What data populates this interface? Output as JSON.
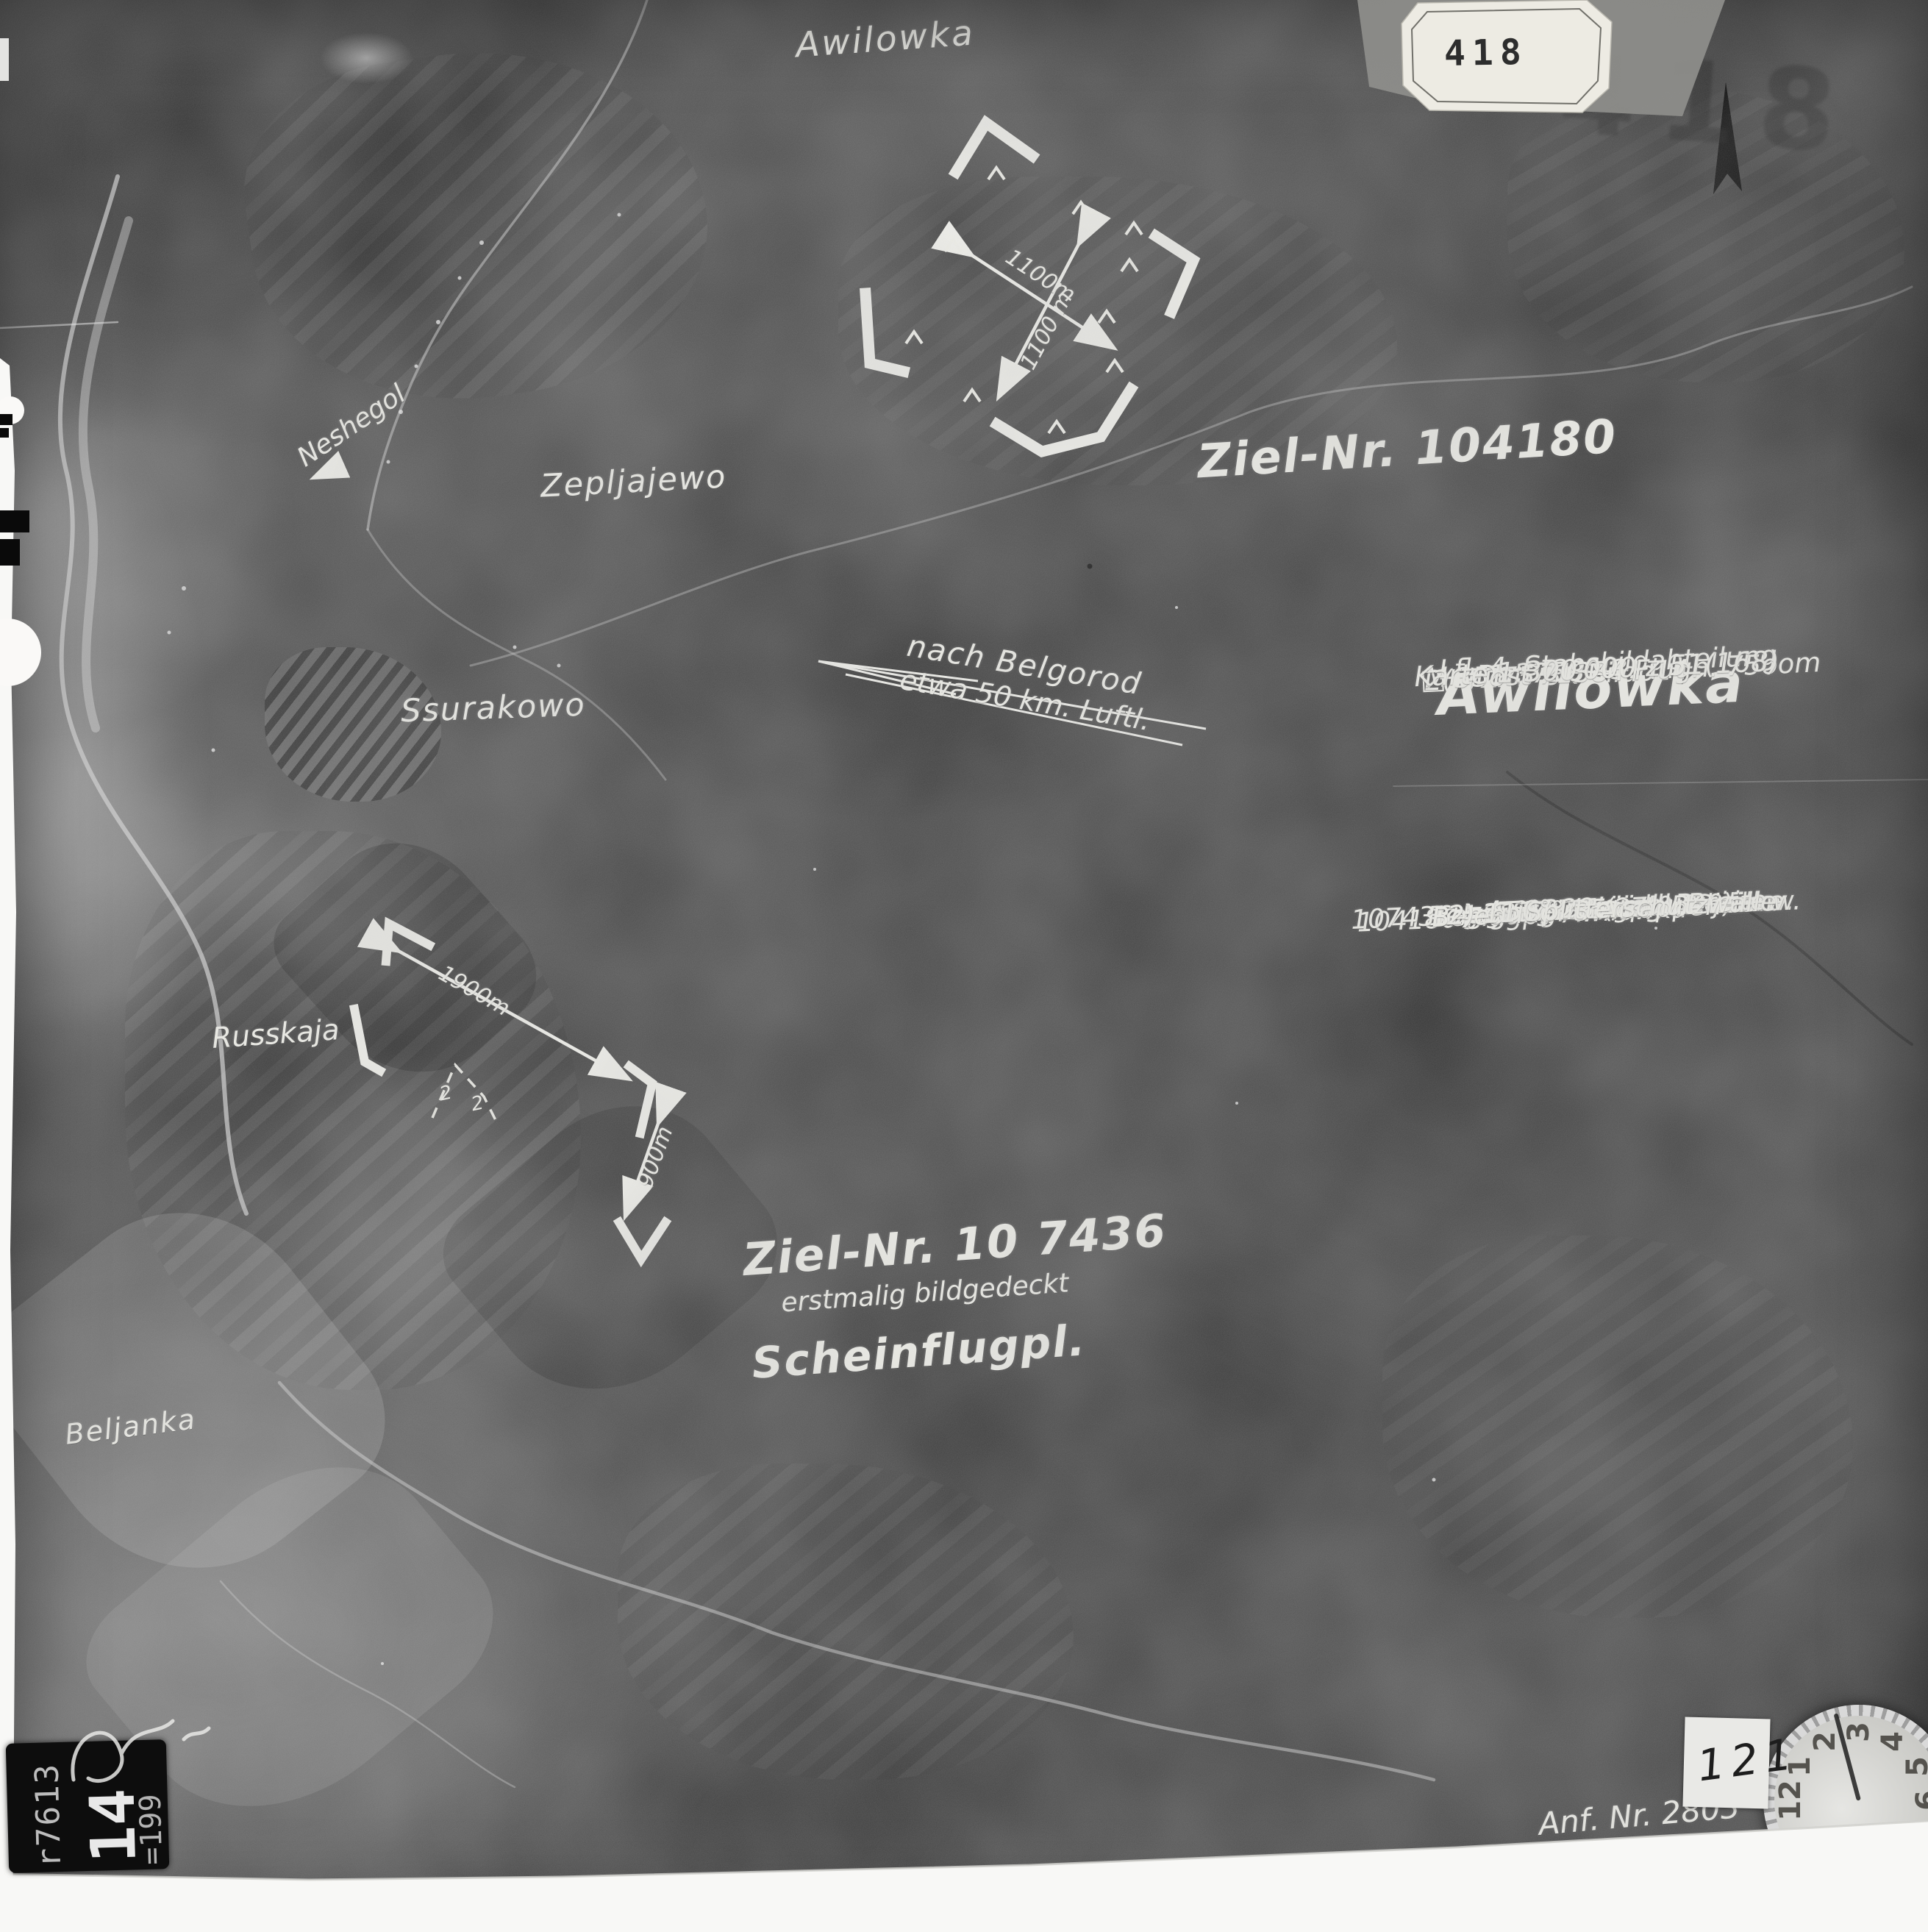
{
  "photo": {
    "tag_number": "418",
    "ghost_number": "418",
    "sticker_number": "121",
    "order_number": "Anf. Nr. 2803",
    "stamp_serial": "r7613",
    "stamp_large": "14",
    "stamp_small": "=199",
    "north_letter": "N",
    "annotation_color": "#eeeee8",
    "paper_color": "#f8f8f6"
  },
  "places": {
    "top": "Awilowka",
    "neshegol": "Neshegol",
    "zepljajewo": "Zepljajewo",
    "ssurakowo": "Ssurakowo",
    "russkaja": "Russkaja",
    "beljanka": "Beljanka"
  },
  "direction": {
    "line1": "nach Belgorod",
    "line2": "etwa 50 km. Luftl."
  },
  "target1": {
    "label": "Ziel-Nr. 104180",
    "dim_a": "1100m",
    "dim_b": "1100 m"
  },
  "target2": {
    "label": "Ziel-Nr. 10 7436",
    "note": "erstmalig bildgedeckt",
    "type": "Scheinflugpl.",
    "dim_a": "1900m",
    "dim_b": "900m",
    "mark_a": "2",
    "mark_b": "2"
  },
  "info": {
    "unit": "Lfl. 4, Stabsbildabteilung",
    "squadron": "2(F)11",
    "film": "F275 SK Bildo14",
    "scale": "M = 1:37500",
    "date": "Dat. 2.8.43.",
    "title": "Awilowka",
    "grid": "□ 35ost 71384 Flugh. 75oom",
    "map": "Karte 1:300 000   z 51(168)"
  },
  "auswertung": {
    "heading": "Auswertung:",
    "l1": "104180 Flugpl. Awilowka",
    "l2": "Lage: 37°18′ ostw. Greenw.",
    "l3": "50°30′ nördl. Breite",
    "l4": "Belegung: 27(27·0·0·0)",
    "l5": "1) 38 Splitterschutzwälle",
    "l6": "107436 = Scheinflugpl. Beljanka",
    "l7": "Lage: 37° 15 ostw. Greenw.",
    "l8": "50° 28 nördl. Breite",
    "l9": "Belegung: 3 Atrappen",
    "l10": "2) 11 Splitterschutzwälle"
  },
  "clock": {
    "numbers": [
      "12",
      "1",
      "2",
      "3",
      "4",
      "5",
      "6"
    ]
  }
}
